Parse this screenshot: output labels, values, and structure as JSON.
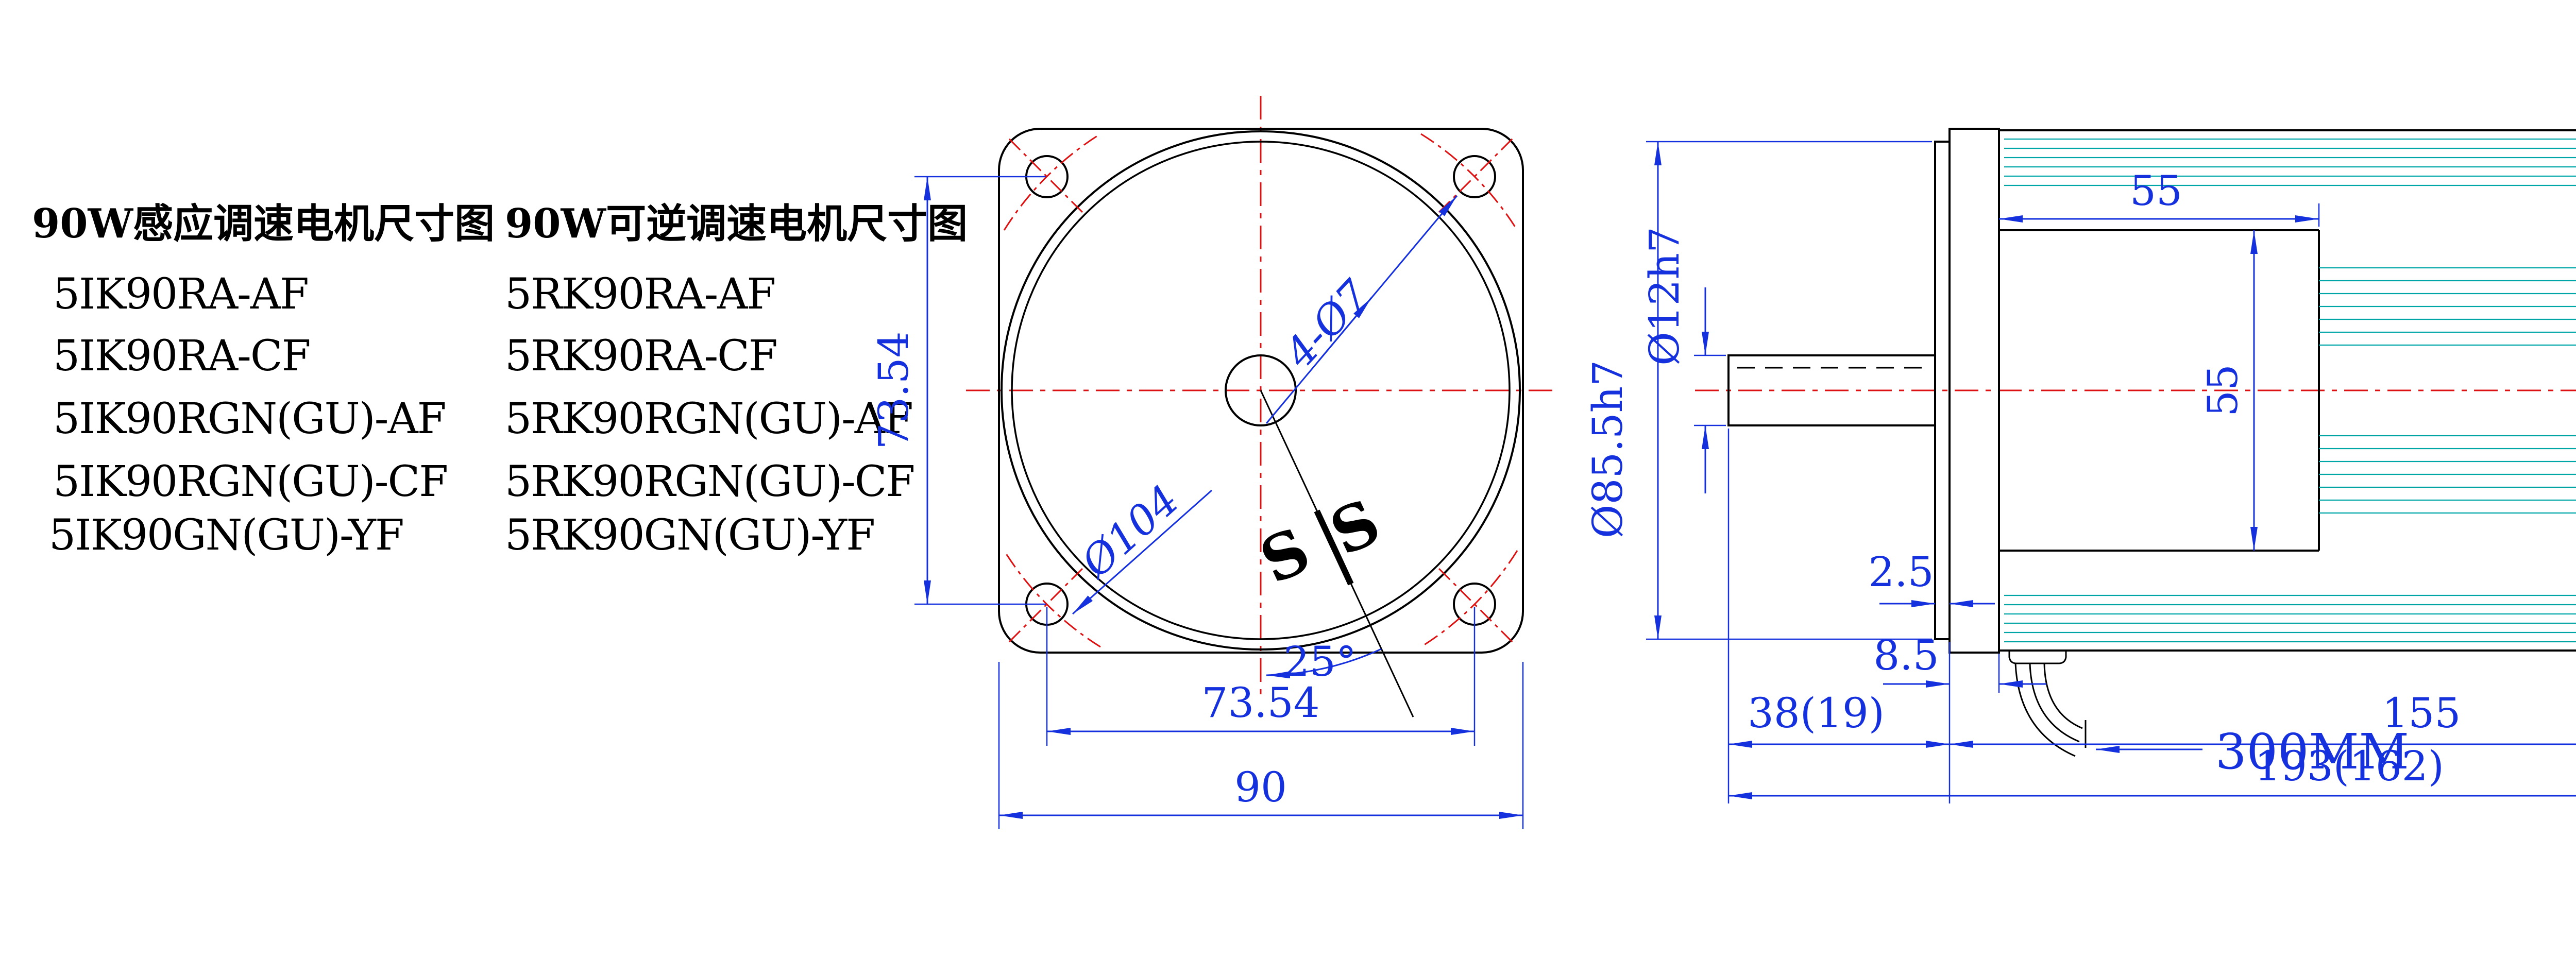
{
  "colors": {
    "outline": "#000000",
    "centerline": "#dd1111",
    "dimension": "#1530dd",
    "fins": "#00a6a6",
    "background": "#ffffff"
  },
  "left_panel": {
    "columns": [
      {
        "title": "90W感应调速电机尺寸图",
        "models": [
          "5IK90RA-AF",
          "5IK90RA-CF",
          "5IK90RGN(GU)-AF",
          "5IK90RGN(GU)-CF",
          "5IK90GN(GU)-YF"
        ]
      },
      {
        "title": "90W可逆调速电机尺寸图",
        "models": [
          "5RK90RA-AF",
          "5RK90RA-CF",
          "5RK90RGN(GU)-AF",
          "5RK90RGN(GU)-CF",
          "5RK90GN(GU)-YF"
        ]
      }
    ]
  },
  "front_view": {
    "dim_vertical_hole_pitch": "73.54",
    "dim_horizontal_hole_pitch": "73.54",
    "dim_overall_width": "90",
    "label_bolt_circle": "Ø104",
    "label_holes": "4-Ø7",
    "label_angle": "25°",
    "logo_left": "S",
    "logo_right": "S"
  },
  "side_view": {
    "dim_front_section_length": "55",
    "dim_core_height": "55",
    "label_shaft_dia": "Ø12h7",
    "label_pilot_dia": "Ø85.5h7",
    "dim_pilot_protrusion": "2.5",
    "dim_flange_thickness": "8.5",
    "dim_shaft_length": "38(19)",
    "dim_body_length": "155",
    "dim_total_length": "193(162)",
    "label_lead_wire": "300MM",
    "dim_body_height": "89"
  }
}
